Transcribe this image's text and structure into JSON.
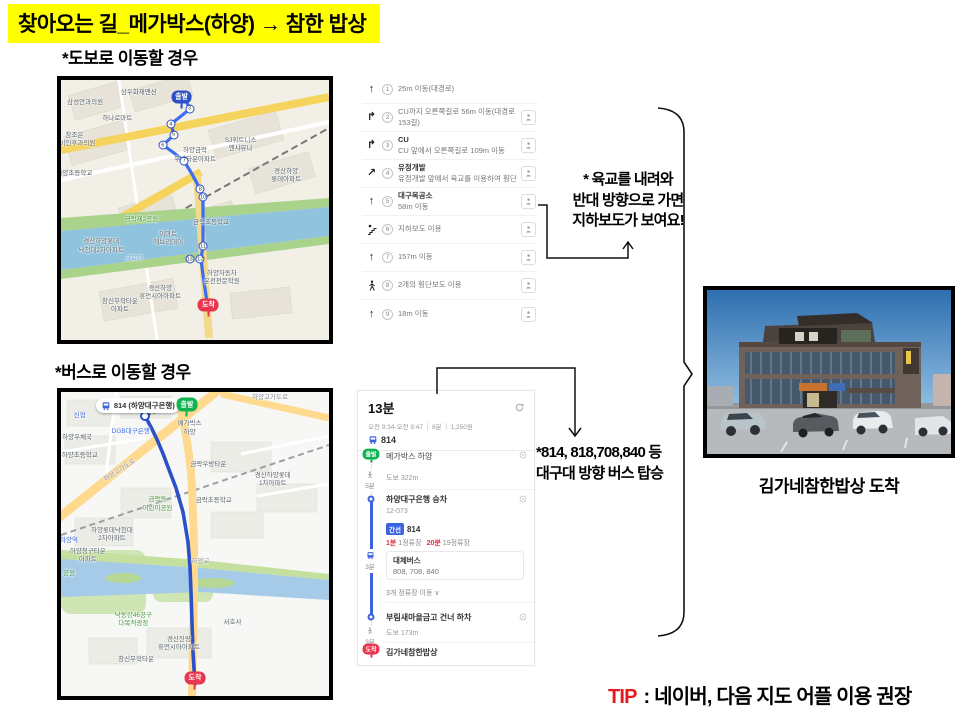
{
  "title": "찾아오는 길_메가박스(하양) → 참한 밥상",
  "walk": {
    "heading": "*도보로 이동할 경우",
    "note_lines": [
      "* 육교를 내려와",
      "반대 방향으로 가면",
      "지하보도가 보여요!"
    ],
    "steps": [
      {
        "num": "1",
        "icon": "straight-arrow-icon",
        "lines": [
          "25m 이동(대경로)"
        ],
        "streetview": false
      },
      {
        "num": "2",
        "icon": "turn-right-icon",
        "lines": [
          "CU까지 오른쪽길로 56m 이동(대경로153길)"
        ],
        "streetview": true
      },
      {
        "num": "3",
        "icon": "turn-right-icon",
        "lines": [
          "CU",
          "CU 앞에서 오른쪽길로 109m 이동"
        ],
        "streetview": true
      },
      {
        "num": "4",
        "icon": "diagonal-right-icon",
        "lines": [
          "유정개발",
          "유정개발 앞에서 육교를 이용하여 횡단"
        ],
        "streetview": true
      },
      {
        "num": "5",
        "icon": "straight-arrow-icon",
        "lines": [
          "대구목공소",
          "58m 이동"
        ],
        "streetview": true
      },
      {
        "num": "6",
        "icon": "stairs-icon",
        "lines": [
          "지하보도 이용"
        ],
        "streetview": true
      },
      {
        "num": "7",
        "icon": "straight-arrow-icon",
        "lines": [
          "157m 이동"
        ],
        "streetview": true
      },
      {
        "num": "8",
        "icon": "crosswalk-icon",
        "lines": [
          "2개의 횡단보도 이용"
        ],
        "streetview": true
      },
      {
        "num": "9",
        "icon": "straight-arrow-icon",
        "lines": [
          "18m 이동"
        ],
        "streetview": true
      }
    ],
    "map": {
      "start_label": "출발",
      "end_label": "도착",
      "labels": [
        {
          "t": "삼성안과의원",
          "x": 9,
          "y": 9
        },
        {
          "t": "삼우화재맨션",
          "x": 29,
          "y": 5
        },
        {
          "t": "하나로마트",
          "x": 21,
          "y": 15
        },
        {
          "t": "참조은\n이비인후과의원",
          "x": 5,
          "y": 23
        },
        {
          "t": "하양금락\n우방타운아파트",
          "x": 50,
          "y": 29
        },
        {
          "t": "SJ휘트니스\n엔샤뮤나",
          "x": 67,
          "y": 25
        },
        {
          "t": "경산하양\n롯데아파트",
          "x": 84,
          "y": 37
        },
        {
          "t": "하양초등학교",
          "x": 5,
          "y": 36
        },
        {
          "t": "금락제2공원",
          "x": 30,
          "y": 54,
          "c": "green"
        },
        {
          "t": "이마트\n에브리데이",
          "x": 40,
          "y": 61
        },
        {
          "t": "경산하양롯데\n낙천대2차아파트",
          "x": 15,
          "y": 64
        },
        {
          "t": "금락초등학교",
          "x": 56,
          "y": 55
        },
        {
          "t": "금호강",
          "x": 27,
          "y": 69,
          "c": "water"
        },
        {
          "t": "하양자동차\n운전전문학원",
          "x": 60,
          "y": 76
        },
        {
          "t": "경산하양\n휴먼시아아파트",
          "x": 37,
          "y": 82
        },
        {
          "t": "창신무학타운\n아파트",
          "x": 22,
          "y": 87
        }
      ],
      "route_markers": [
        {
          "n": "3",
          "x": 48,
          "y": 11
        },
        {
          "n": "4",
          "x": 41,
          "y": 17
        },
        {
          "n": "5",
          "x": 42,
          "y": 21
        },
        {
          "n": "6",
          "x": 38,
          "y": 25
        },
        {
          "n": "7",
          "x": 46,
          "y": 31
        },
        {
          "n": "8",
          "x": 52,
          "y": 42
        },
        {
          "n": "10",
          "x": 53,
          "y": 45
        },
        {
          "n": "11",
          "x": 53,
          "y": 64
        },
        {
          "n": "12",
          "x": 52,
          "y": 69
        },
        {
          "n": "13",
          "x": 48,
          "y": 69
        }
      ]
    }
  },
  "bus": {
    "heading": "*버스로 이동할 경우",
    "note_lines": [
      "*814, 818,708,840 등",
      "대구대 방향 버스 탑승"
    ],
    "panel": {
      "duration": "13분",
      "time_range": "오전 9:34-오전 9:47",
      "walk_total": "8분",
      "fare": "1,250원",
      "bus_no": "814",
      "start_badge": "출발",
      "end_badge": "도착",
      "start_stop": "메가박스 하양",
      "walk1": "도보 322m",
      "walk1_time": "5분",
      "board_stop": "하양대구은행 승차",
      "stop_id": "12-073",
      "badge": "간선",
      "badge_bus": "814",
      "wait1": "1분",
      "wait1_sub": "1정류장",
      "wait2": "20분",
      "wait2_sub": "19정류장",
      "alt_title": "대체버스",
      "alt_buses": "808, 708, 840",
      "stops_move": "3개 정류장 이동 ∨",
      "ride_time": "3분",
      "alight_stop": "부림새마을금고 건너 하차",
      "walk2": "도보 173m",
      "walk2_time": "3분",
      "end_stop": "김가네참한밥상"
    },
    "map": {
      "start_label": "출발",
      "end_label": "도착",
      "bus_label": "814 (하양대구은행)",
      "labels": [
        {
          "t": "신협",
          "x": 7,
          "y": 8,
          "c": "blue"
        },
        {
          "t": "국민은행",
          "x": 25,
          "y": 4
        },
        {
          "t": "DGB대구은행",
          "x": 26,
          "y": 13,
          "c": "blue"
        },
        {
          "t": "하양우체국",
          "x": 6,
          "y": 15
        },
        {
          "t": "하양초등학교",
          "x": 7,
          "y": 21
        },
        {
          "t": "메가박스\n하양",
          "x": 48,
          "y": 12
        },
        {
          "t": "하양고가도로",
          "x": 22,
          "y": 26,
          "rot": -33,
          "c": "road"
        },
        {
          "t": "하양고가도로",
          "x": 78,
          "y": 2,
          "c": "road"
        },
        {
          "t": "금락우방타운",
          "x": 55,
          "y": 24
        },
        {
          "t": "경산하양롯데\n1차아파트",
          "x": 79,
          "y": 29
        },
        {
          "t": "금락동\n어린이공원",
          "x": 36,
          "y": 37,
          "c": "green"
        },
        {
          "t": "금락초등학교",
          "x": 57,
          "y": 36
        },
        {
          "t": "하양롯데낙천대\n2차아파트",
          "x": 19,
          "y": 47
        },
        {
          "t": "하양역",
          "x": 3,
          "y": 49,
          "c": "blue"
        },
        {
          "t": "하양청구타운\n아파트",
          "x": 10,
          "y": 54
        },
        {
          "t": "공원",
          "x": 3,
          "y": 60,
          "c": "green"
        },
        {
          "t": "하양교",
          "x": 52,
          "y": 56,
          "c": "road"
        },
        {
          "t": "낙동강46공구\n다목적광장",
          "x": 27,
          "y": 75,
          "c": "green"
        },
        {
          "t": "서호사",
          "x": 64,
          "y": 76
        },
        {
          "t": "경산진량\n휴먼시아아파트",
          "x": 44,
          "y": 83
        },
        {
          "t": "창신무학타운",
          "x": 28,
          "y": 88
        }
      ],
      "route_markers": []
    }
  },
  "photo_caption": "김가네참한밥상  도착",
  "tip": {
    "label": "TIP",
    "text": " : 네이버, 다음 지도 어플 이용 권장"
  },
  "colors": {
    "highlight": "#ffff00",
    "tip_red": "#e8191c",
    "route_blue": "#2b50c8",
    "bus_blue": "#3b63e0",
    "start_green": "#10b350",
    "end_red": "#e8364f"
  }
}
